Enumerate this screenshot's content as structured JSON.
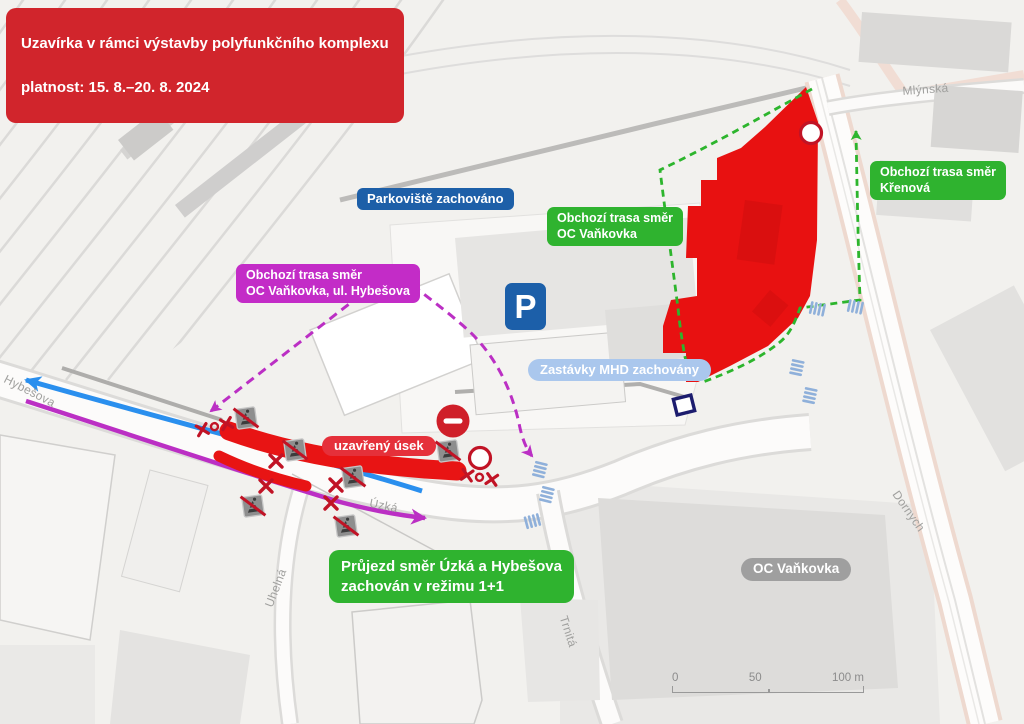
{
  "banner": {
    "title": "Uzavírka v rámci výstavby polyfunkčního komplexu",
    "validity": "platnost: 15. 8.–20. 8. 2024"
  },
  "labels": {
    "parking": "Parkoviště zachováno",
    "detour_vankovka": "Obchozí trasa směr\nOC Vaňkovka",
    "detour_krenova": "Obchozí trasa směr\nKřenová",
    "detour_hybesova": "Obchozí trasa směr\nOC Vaňkovka, ul. Hybešova",
    "mhd_stops": "Zastávky MHD zachovány",
    "closed_section": "uzavřený úsek",
    "transit_mode": "Průjezd směr Úzká a Hybešova\nzachován v režimu 1+1",
    "oc_vankovka": "OC Vaňkovka"
  },
  "map": {
    "parking_icon": "P"
  },
  "streets": {
    "hybesova": "Hybešova",
    "uzka": "Úzká",
    "uhelna": "Uhelná",
    "trnita": "Trnitá",
    "mlynska": "Mlýnská",
    "dornych": "Dornych"
  },
  "scale": {
    "zero": "0",
    "fifty": "50",
    "hundred": "100 m"
  },
  "icons": {
    "parking": "parking-icon",
    "no_entry": "no-entry-sign",
    "closed_crossing": "crossed-pedestrian-crossing-sign",
    "barrier": "red-x-barrier",
    "closure_point": "closure-point-circle",
    "mhd_stop": "mhd-stop-marker"
  },
  "colors": {
    "banner_red": "#d1252c",
    "closure_red": "#e81111",
    "detour_green": "#2db52d",
    "detour_magenta": "#bb2fc4",
    "route_blue": "#2a8fee",
    "label_blue": "#1d5fa8",
    "mhd_lightblue": "#aac7ed",
    "gray_label": "#9f9f9f"
  }
}
